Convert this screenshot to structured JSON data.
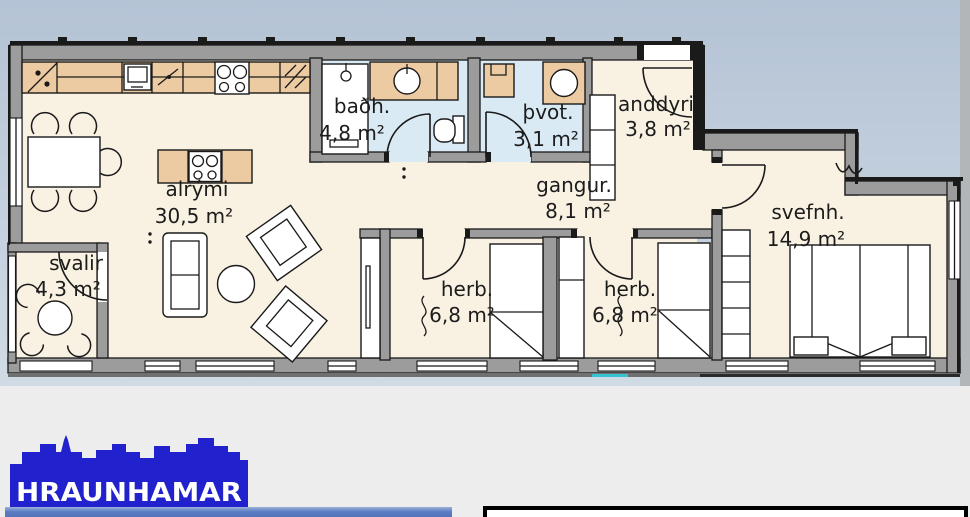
{
  "plan": {
    "rooms": [
      {
        "name": "alrými",
        "area": "30,5 m²"
      },
      {
        "name": "baðh.",
        "area": "4,8 m²"
      },
      {
        "name": "þvot.",
        "area": "3,1 m²"
      },
      {
        "name": "anddyri",
        "area": "3,8 m²"
      },
      {
        "name": "gangur.",
        "area": "8,1 m²"
      },
      {
        "name": "herb.",
        "area": "6,8 m²"
      },
      {
        "name": "herb.",
        "area": "6,8 m²"
      },
      {
        "name": "svefnh.",
        "area": "14,9 m²"
      },
      {
        "name": "svalir",
        "area": "4,3 m²"
      }
    ]
  },
  "logo": {
    "brand": "HRAUNHAMAR"
  },
  "colors": {
    "sky_top": "#b4c3d5",
    "sky_bottom": "#d0dbe5",
    "page_gray": "#ededed",
    "wall_gray": "#9c9c9c",
    "outline_black": "#1a1a1a",
    "floor_cream": "#f9f2e3",
    "wet_room_blue": "#d9eaf5",
    "counter_tan": "#eccaa2",
    "logo_blue": "#2121ce",
    "footer_bar_blue": "#5b7ec5",
    "teal_mark": "#35c4cf"
  }
}
